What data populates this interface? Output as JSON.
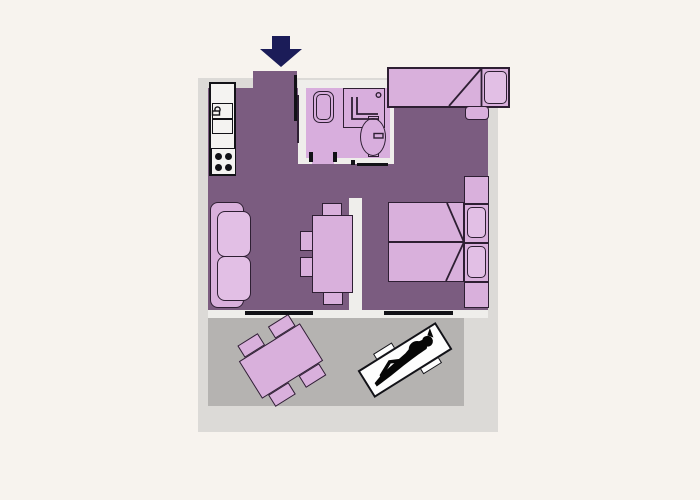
{
  "app": {
    "name": "apartment-floor-plan",
    "view": "2d-top-down"
  },
  "palette": {
    "background": "#f7f3ee",
    "plot_wall": "#dcdad7",
    "inner_wall": "#efeeeb",
    "floor_main": "#7b5c80",
    "floor_bathroom": "#d8aedd",
    "floor_terrace": "#b5b3b1",
    "furniture": "#d9b0dc",
    "furniture_light": "#e2bfe5",
    "outline": "#2e1f33",
    "hard_line": "#121217",
    "entrance_arrow": "#1b1c58",
    "lounger": "#fdfdfd",
    "person": "#060606"
  },
  "icons": {
    "entrance": "arrow-down-icon",
    "kitchen": [
      "kitchen-counter",
      "kitchen-sink",
      "stove-four-burners"
    ],
    "bathroom": [
      "toilet",
      "shower-cabin",
      "washbasin"
    ],
    "bedroom": [
      "double-bed",
      "bed-pillows",
      "nightstands",
      "door-line"
    ],
    "sleeping_niche": [
      "single-bed",
      "bed-stool"
    ],
    "living_room": [
      "sofa",
      "dining-table",
      "chairs"
    ],
    "terrace": [
      "garden-table",
      "garden-chairs",
      "sun-lounger",
      "person-sunbathing-silhouette"
    ],
    "openings": [
      "entrance-door-line",
      "terrace-window-living",
      "terrace-window-bedroom",
      "bathroom-door-ticks"
    ]
  }
}
